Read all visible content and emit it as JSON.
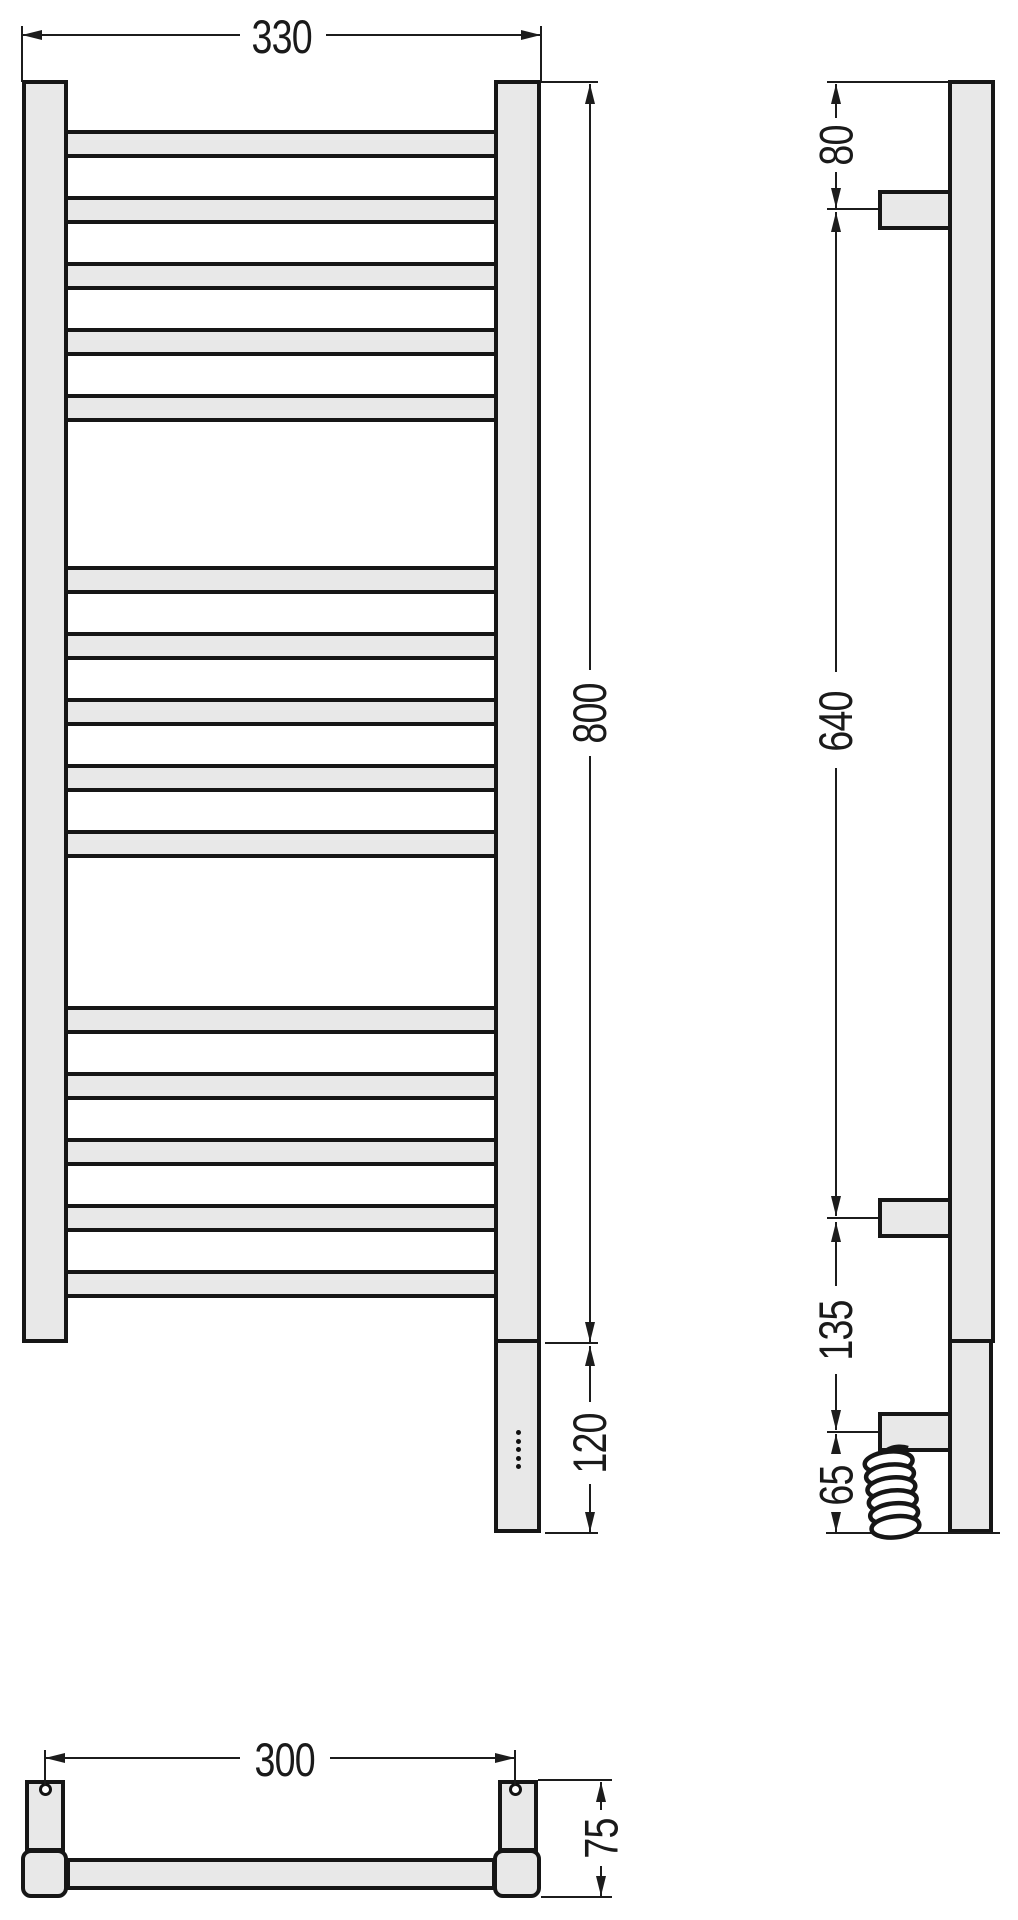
{
  "drawing": {
    "title": "Heated towel rail — dimensional drawing",
    "units": "mm",
    "views": {
      "front": {
        "name": "front-view",
        "rung_groups": 3,
        "rungs_per_group": 5,
        "control_dots": 5
      },
      "side": {
        "name": "side-view",
        "wall_brackets": 2,
        "outlet_brackets": 1,
        "coil_loops": 6
      },
      "bottom": {
        "name": "bottom-view",
        "mount_holes": 2
      }
    },
    "dimensions": {
      "overall_width": "330",
      "overall_height": "800",
      "heater_section": "120",
      "top_to_bracket": "80",
      "bracket_span": "640",
      "bracket_to_outlet": "135",
      "outlet_to_bottom": "65",
      "mount_spacing": "300",
      "depth": "75"
    },
    "colors": {
      "fill": "#e8e8e8",
      "line": "#1c1c1c",
      "background": "#ffffff"
    }
  }
}
